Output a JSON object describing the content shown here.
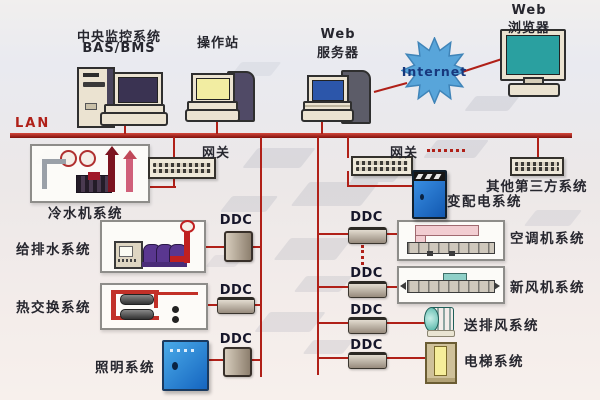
{
  "stations": {
    "central": {
      "line1": "中央监控系统",
      "line2": "BAS/BMS"
    },
    "operator": {
      "label": "操作站"
    },
    "web_server": {
      "line1": "Web",
      "line2": "服务器"
    },
    "internet": {
      "label": "Internet"
    },
    "web_browser": {
      "line1": "Web",
      "line2": "浏览器"
    }
  },
  "lan": {
    "label": "LAN"
  },
  "gateway": {
    "left_label": "网关",
    "right_label": "网关"
  },
  "ddc": {
    "middle": [
      "DDC",
      "DDC",
      "DDC"
    ],
    "right": [
      "DDC",
      "DDC",
      "DDC",
      "DDC"
    ]
  },
  "systems": {
    "chiller": "冷水机系统",
    "water_supply": "给排水系统",
    "heat_exchange": "热交换系统",
    "lighting": "照明系统",
    "power_distribution": "变配电系统",
    "third_party": "其他第三方系统",
    "air_conditioning": "空调机系统",
    "fresh_air": "新风机系统",
    "supply_exhaust_fan": "送排风系统",
    "elevator": "电梯系统"
  },
  "colors": {
    "wire_red": "#b02018",
    "internet_fill": "#58a5da",
    "internet_text": "#17387d",
    "cabinet_blue": "#1f7ad0",
    "lighting_blue": "#2288dd",
    "fan_teal": "#3fa99a",
    "pump_purple": "#5a3790",
    "screen_navy": "#3a3352",
    "screen_yellow": "#f2eda2",
    "screen_blue": "#2c56aa",
    "screen_teal": "#2aa0a0"
  }
}
